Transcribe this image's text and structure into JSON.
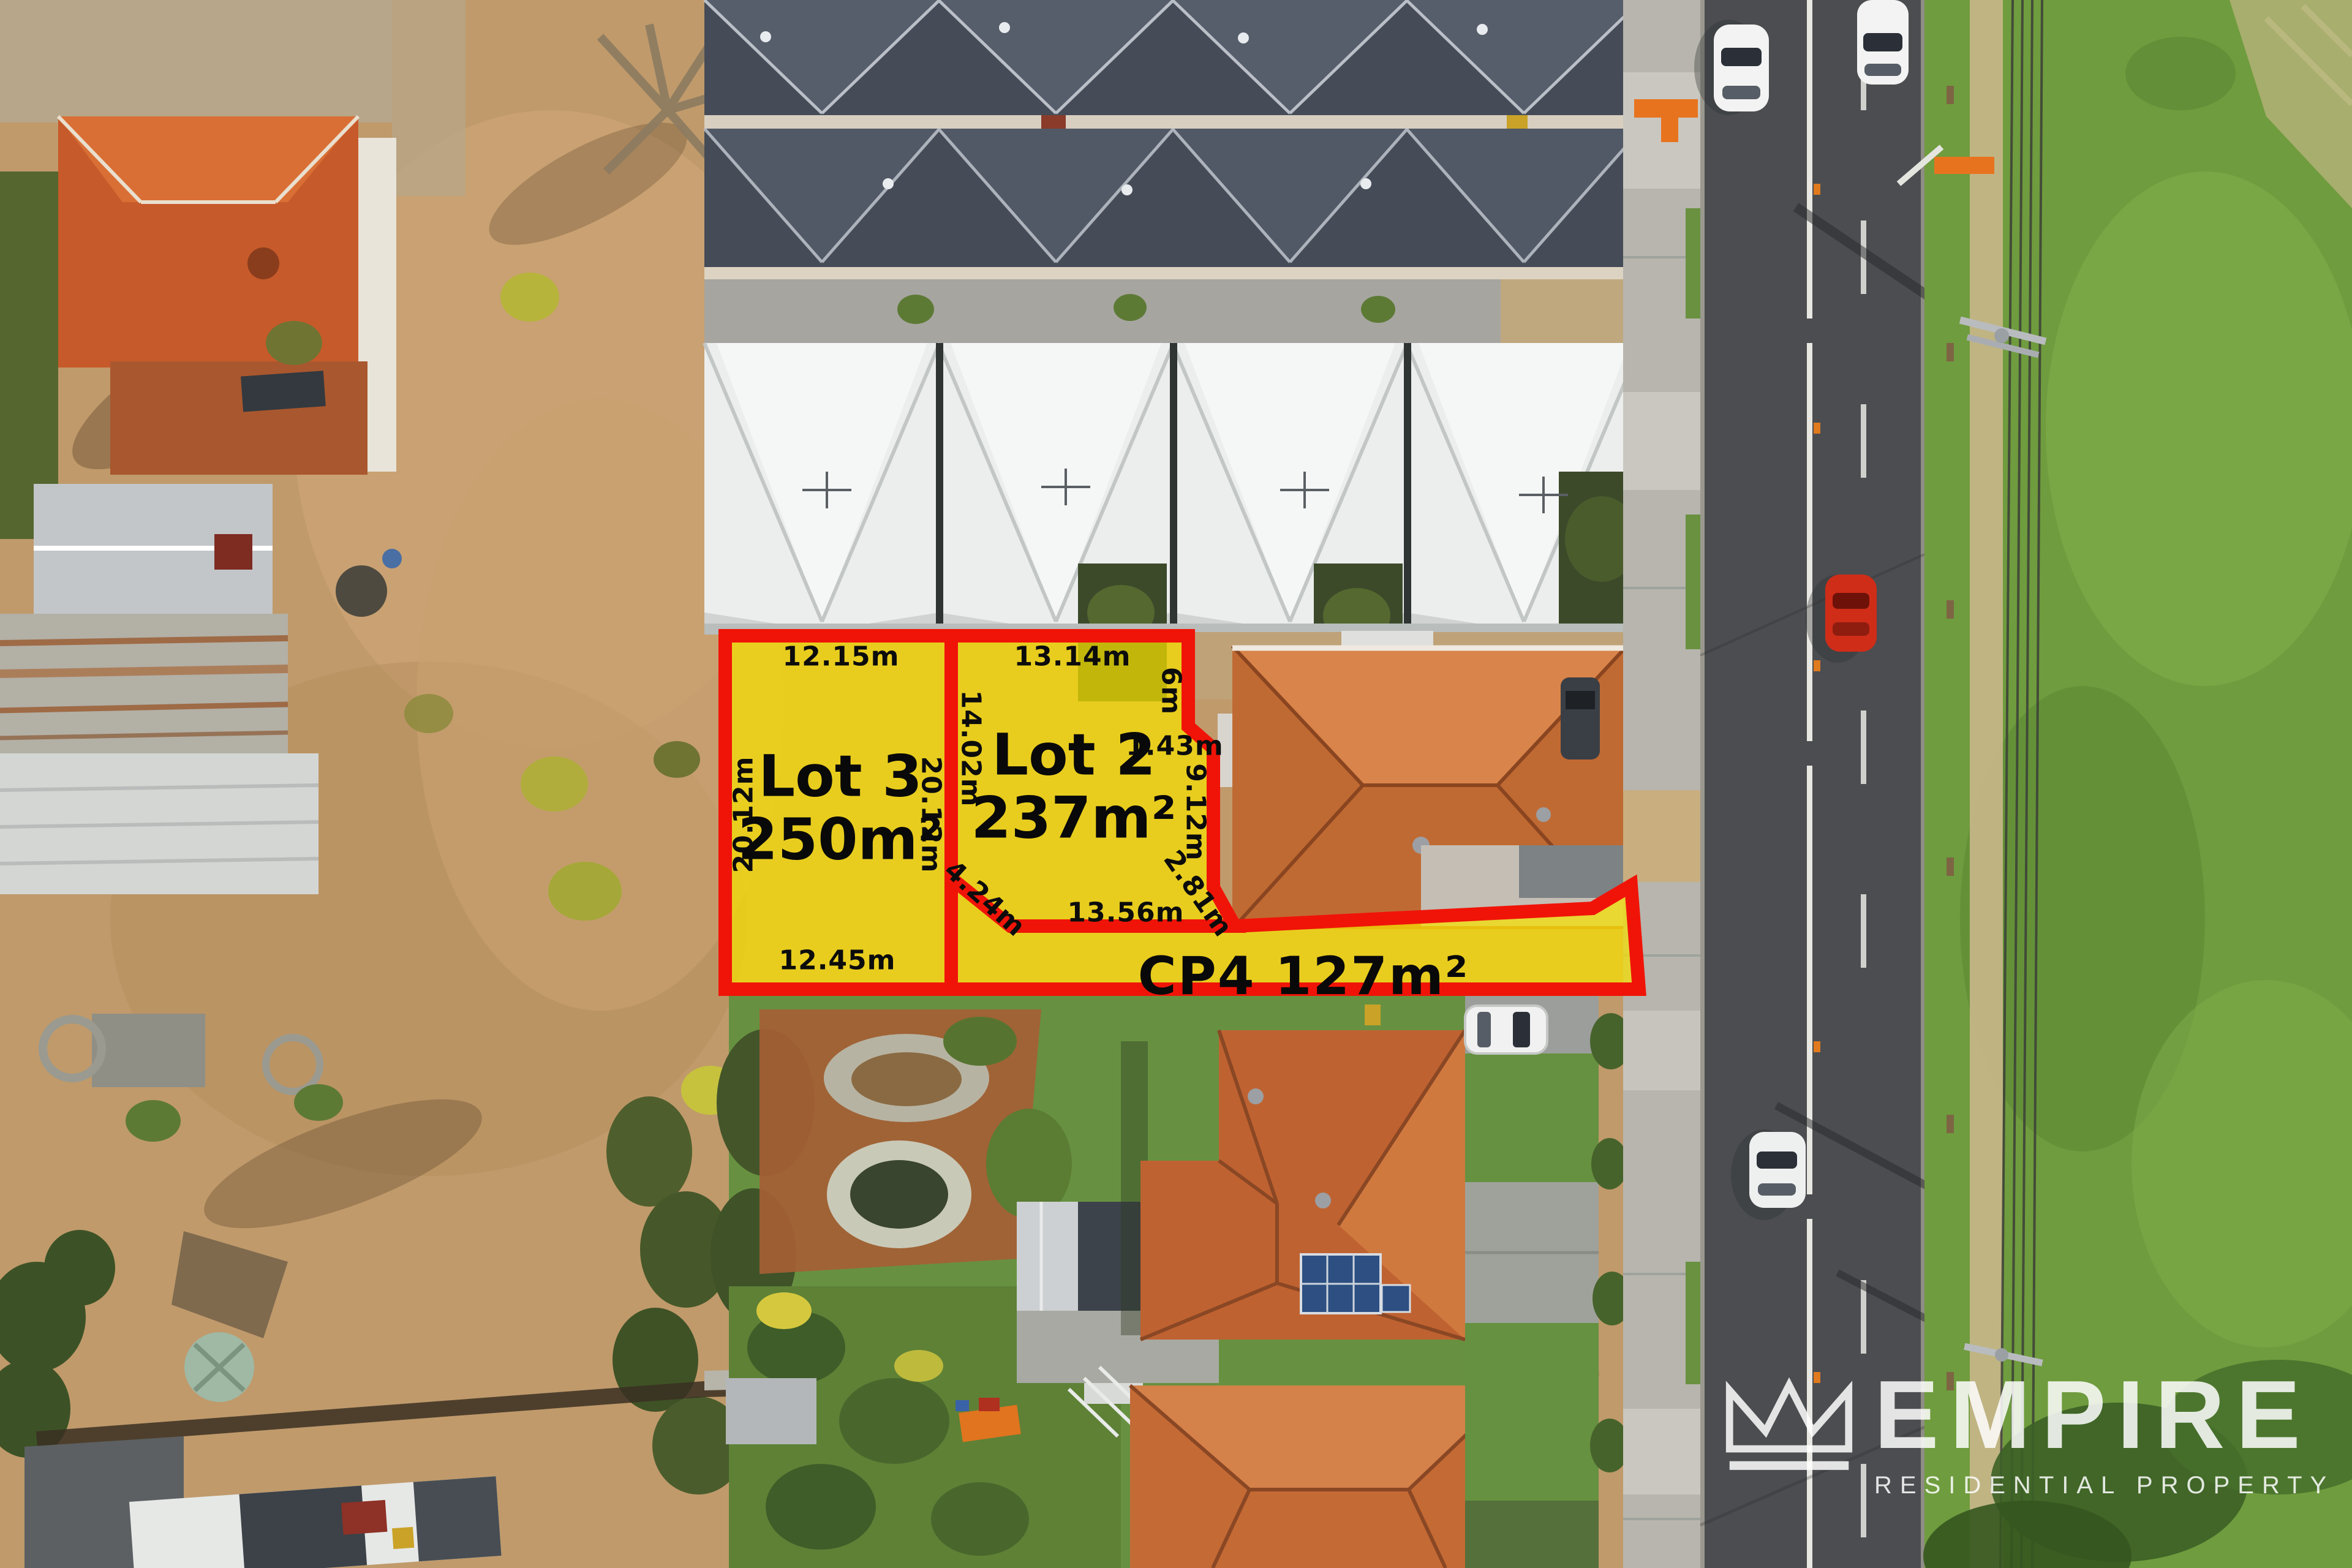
{
  "overlay": {
    "highlight_yellow": "#f7e000",
    "accent_red": "#f01408",
    "label_color": "#0c0c0c",
    "lots": [
      {
        "id": "lot3",
        "name": "Lot 3",
        "area": "250m²",
        "measurements": {
          "top": "12.15m",
          "left": "20.12m",
          "right": "20.12m",
          "bottom": "12.45m"
        }
      },
      {
        "id": "lot2",
        "name": "Lot 2",
        "area": "237m²",
        "measurements": {
          "top": "13.14m",
          "left": "14.02m",
          "right_upper": "6m",
          "right_step": "1.43m",
          "right_lower": "9.12m",
          "right_diagonal": "2.81m",
          "bottom": "13.56m",
          "bottom_left_diagonal": "4.24m"
        }
      },
      {
        "id": "cp4",
        "label": "CP4 127m²"
      }
    ]
  },
  "logo": {
    "icon": "crown-icon",
    "brand": "EMPIRE",
    "tagline": "RESIDENTIAL PROPERTY",
    "color": "#ffffff"
  }
}
